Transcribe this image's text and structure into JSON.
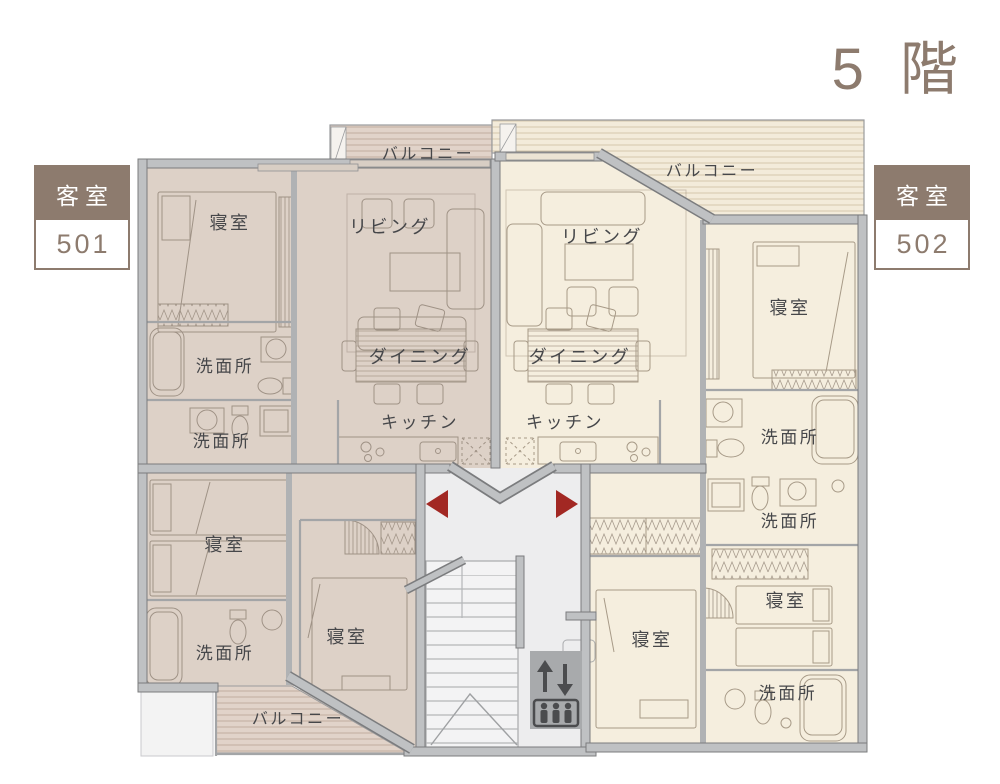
{
  "title": "5 階",
  "units": [
    {
      "label": "客室",
      "number": "501"
    },
    {
      "label": "客室",
      "number": "502"
    }
  ],
  "labels": {
    "balconies": [
      "バルコニー",
      "バルコニー",
      "バルコニー"
    ],
    "living": [
      "リビング",
      "リビング"
    ],
    "dining": [
      "ダイニング",
      "ダイニング"
    ],
    "kitchen": [
      "キッチン",
      "キッチン"
    ],
    "bedrooms": [
      "寝室",
      "寝室",
      "寝室",
      "寝室",
      "寝室",
      "寝室"
    ],
    "washrooms": [
      "洗面所",
      "洗面所",
      "洗面所",
      "洗面所",
      "洗面所",
      "洗面所"
    ]
  },
  "icons": {
    "entry_arrow_left": "left-entry-arrow",
    "entry_arrow_right": "right-entry-arrow",
    "elevator": "elevator-up-down-people"
  },
  "colors": {
    "accent_brown": "#8d7b6e",
    "unit501_fill": "#ddd1c7",
    "unit502_fill": "#f5eede",
    "wall_gray": "#bfc1c3",
    "hall_gray": "#ededee",
    "entry_arrow_red": "#a22823",
    "label_text": "#46474a"
  }
}
